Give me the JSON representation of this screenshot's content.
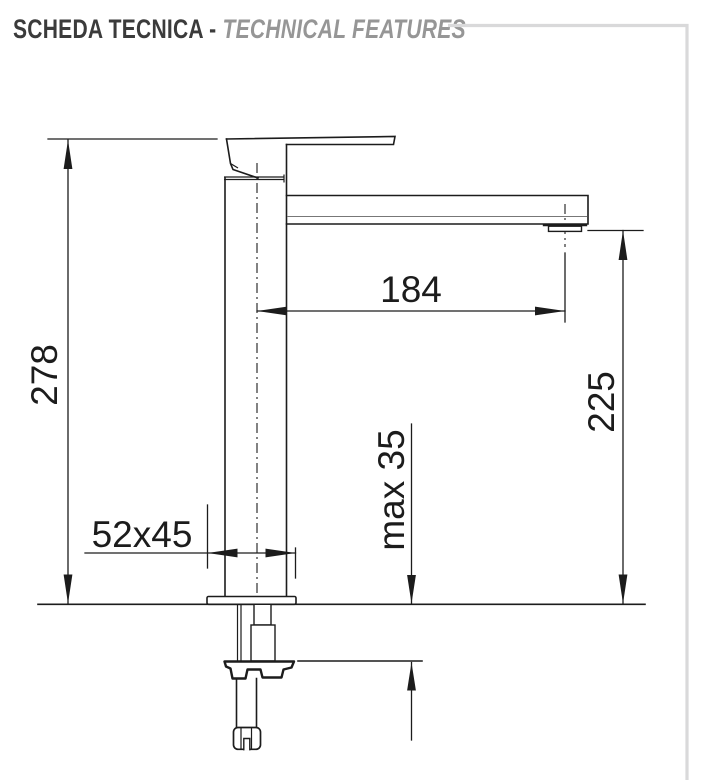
{
  "header": {
    "title_primary": "SCHEDA TECNICA -",
    "title_secondary": "TECHNICAL FEATURES"
  },
  "drawing": {
    "type": "faucet-technical-drawing",
    "dimensions": {
      "total_height": "278",
      "spout_reach": "184",
      "spout_outlet_height": "225",
      "max_deck_thickness": "max 35",
      "base_section": "52x45"
    }
  },
  "colors": {
    "line": "#1c1c1c",
    "frame": "#d9d9da",
    "title_primary": "#3b3b3b",
    "title_secondary": "#969696",
    "inner": "#777777"
  }
}
